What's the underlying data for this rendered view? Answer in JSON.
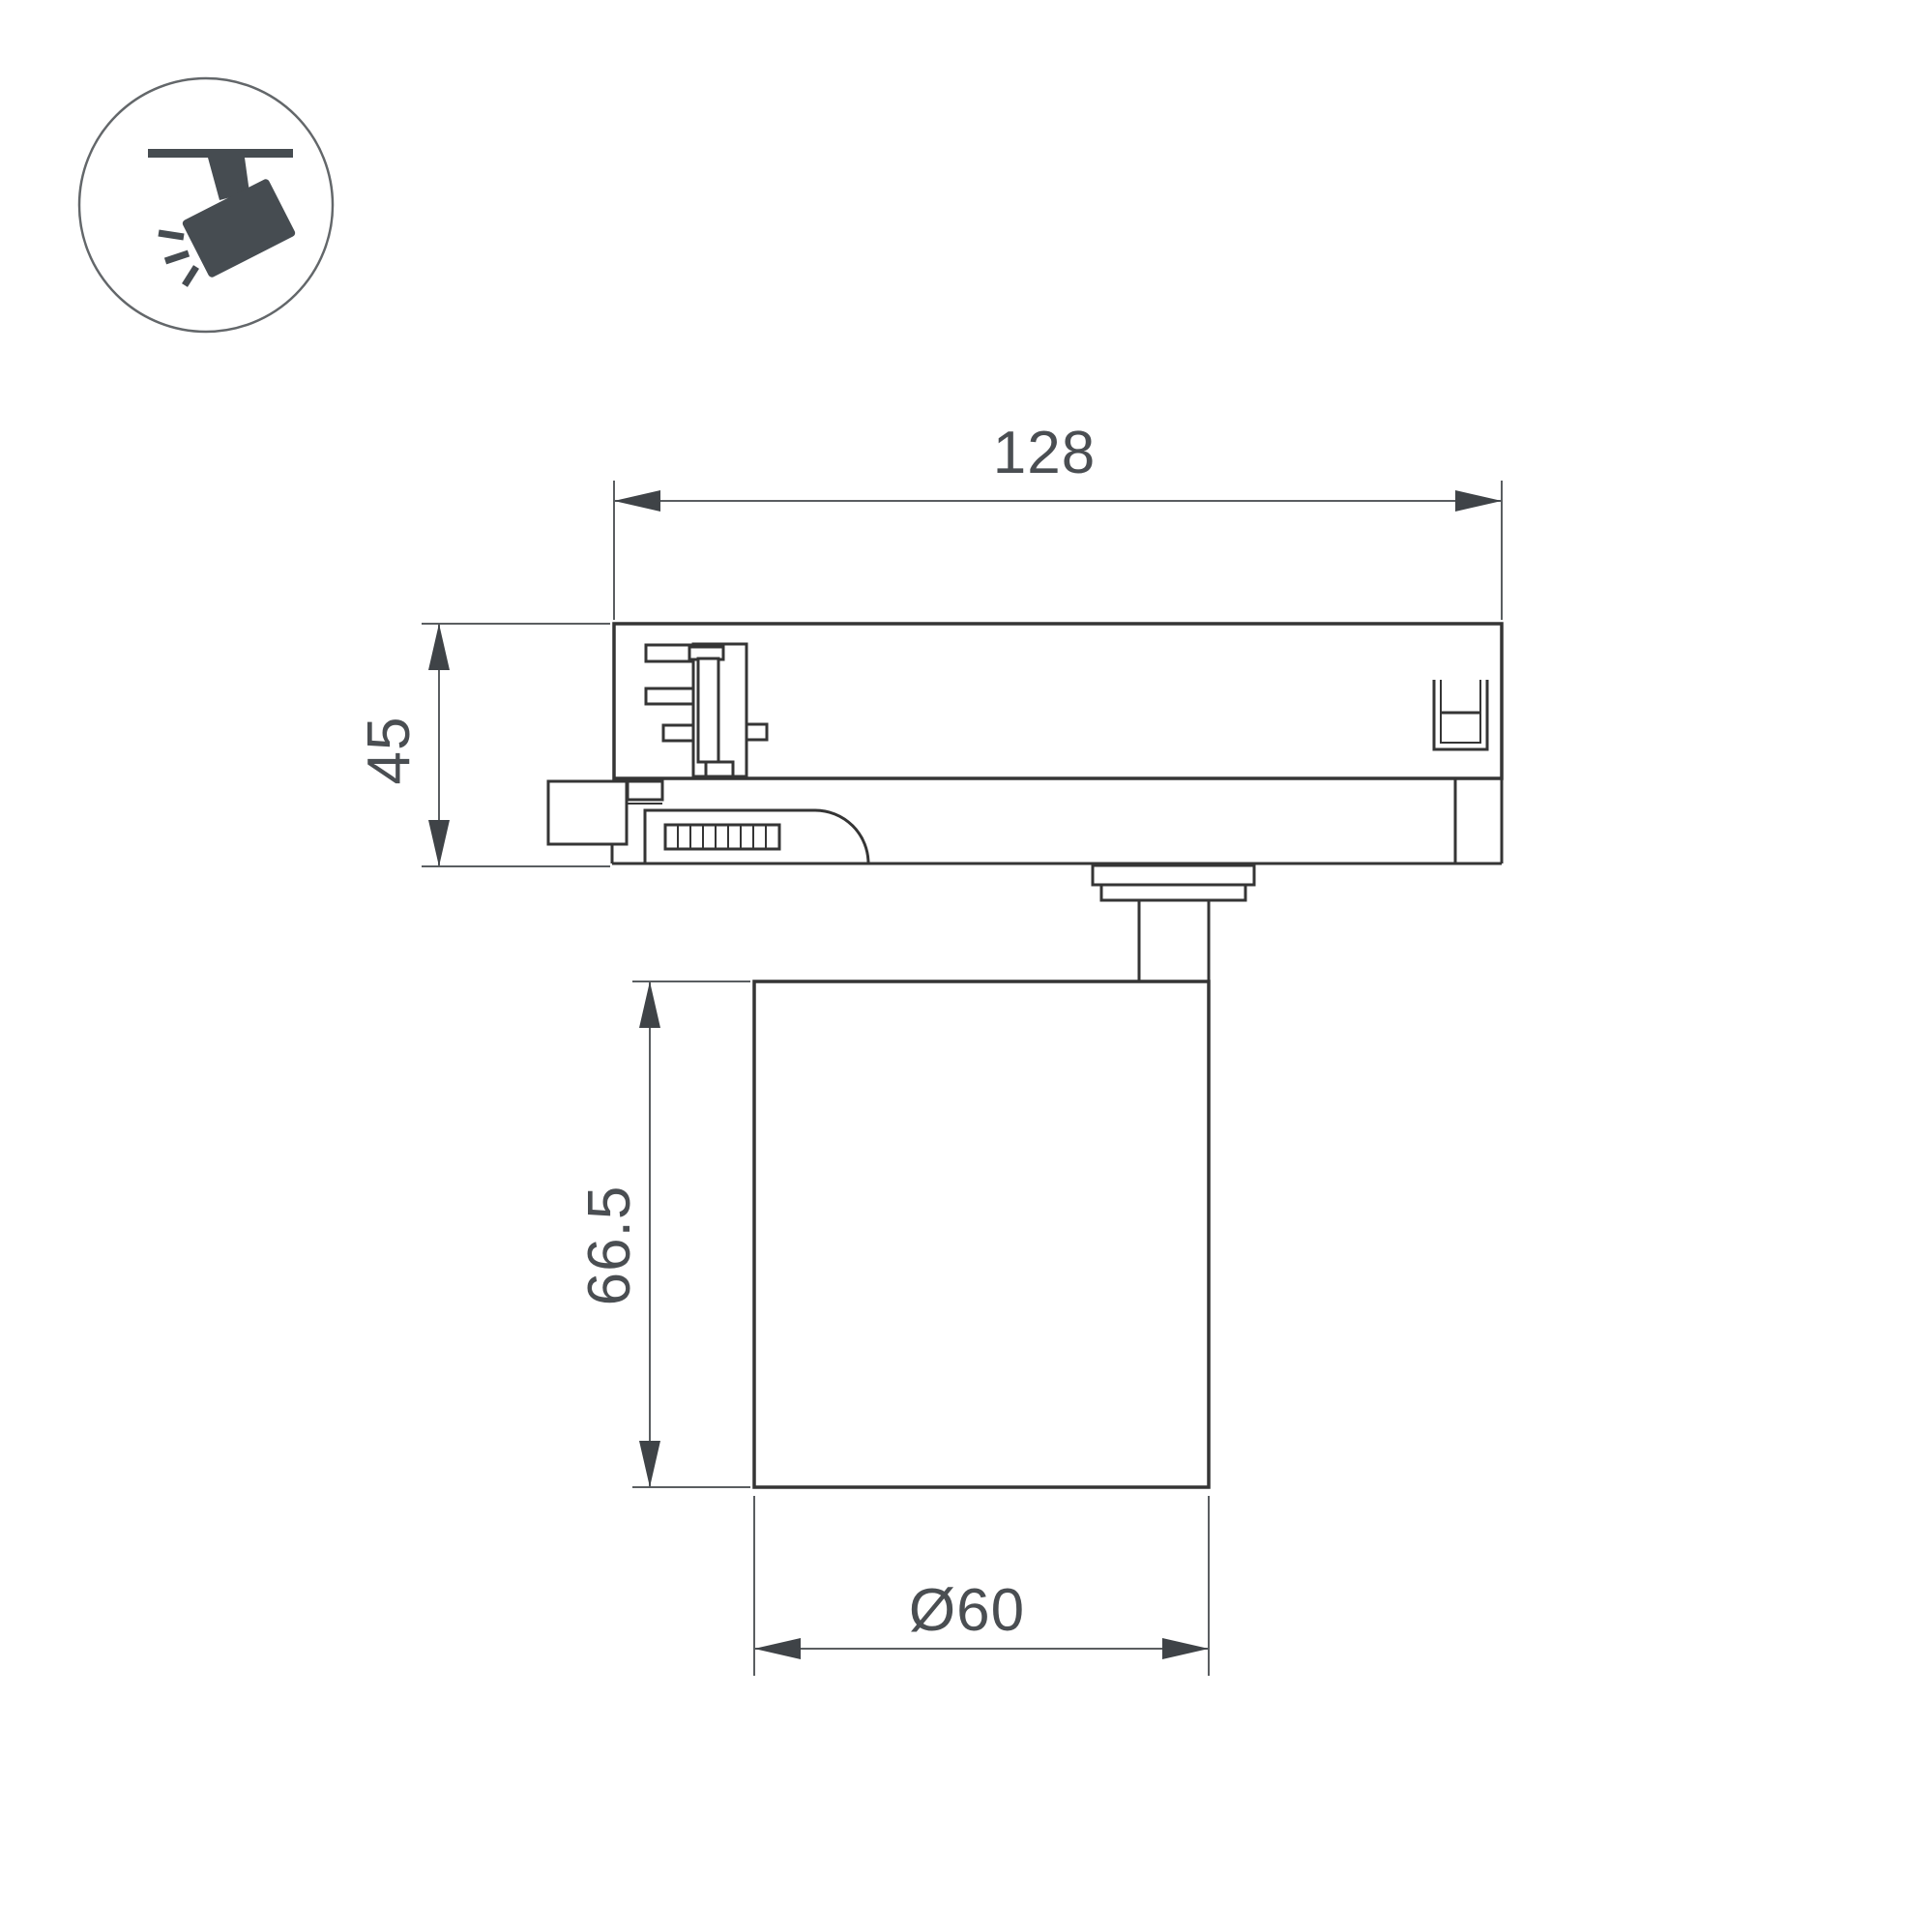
{
  "icon": {
    "name": "ceiling-track-spotlight"
  },
  "dimensions": {
    "track_adapter_width": "128",
    "track_adapter_height": "45",
    "lamp_body_height": "66.5",
    "lamp_body_diameter": "Ø60"
  },
  "colors": {
    "object_line": "#353535",
    "dimension_line": "#5a5e61",
    "label_text": "#4a4e52",
    "icon_glyph": "#464c51",
    "background": "#ffffff"
  }
}
